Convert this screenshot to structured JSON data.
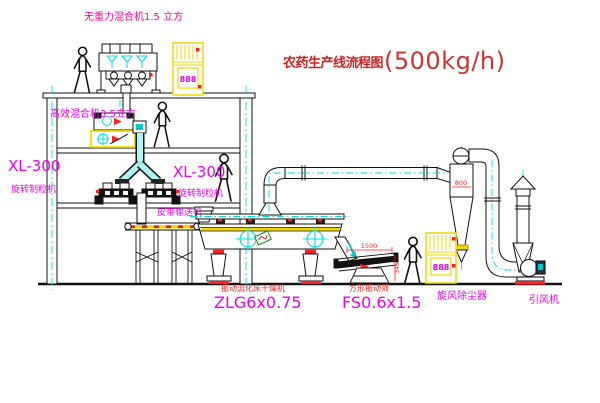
{
  "title": {
    "text": "农药生产线流程图",
    "capacity": "(500kg/h)"
  },
  "labels": {
    "gravity_free_mixer": "无重力混合机1.5 立方",
    "high_eff_mixer": "高效混合机3.5立方",
    "xl300_left": "XL-300",
    "granulator_left": "旋转制粒机",
    "xl300_mid": "XL-300",
    "granulator_mid": "旋转制粒机",
    "belt_conveyor": "皮带输送机",
    "dryer_name": "振动流化床干燥机",
    "dryer_model": "ZLG6x0.75",
    "sieve_name": "方形振动筛",
    "sieve_model": "FS0.6x1.5",
    "cyclone": "旋风除尘器",
    "fan": "引风机"
  },
  "dimensions": {
    "cyclone": "800",
    "sieve_width": "1500",
    "sieve_height": "345"
  },
  "cabinet_display": "888",
  "colors": {
    "line": "#111111",
    "centerline": "#00dddd",
    "accent_yellow": "#ffff00",
    "label_magenta": "#ee00ee",
    "label_red": "#ff2222",
    "title_red": "#cc2222"
  }
}
